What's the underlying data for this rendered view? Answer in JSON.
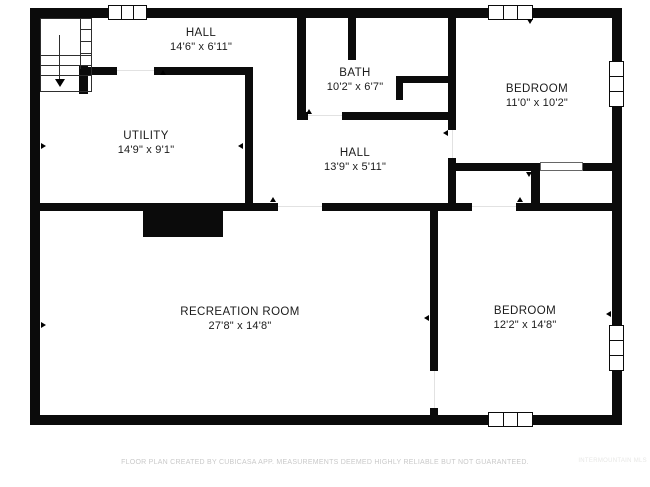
{
  "plan_type": "floor-plan",
  "colors": {
    "wall": "#0b0b0b",
    "background": "#ffffff",
    "room_label_text": "#1b1b1b",
    "footer_text": "#c9c9c9",
    "watermark_text": "#e7e7e5",
    "stairs_line": "#2e2e2e"
  },
  "rooms": [
    {
      "name": "HALL",
      "dims": "14'6\" x 6'11\""
    },
    {
      "name": "BATH",
      "dims": "10'2\" x 6'7\""
    },
    {
      "name": "BEDROOM",
      "dims": "11'0\" x 10'2\""
    },
    {
      "name": "UTILITY",
      "dims": "14'9\" x 9'1\""
    },
    {
      "name": "HALL",
      "dims": "13'9\" x 5'11\""
    },
    {
      "name": "RECREATION ROOM",
      "dims": "27'8\" x 14'8\""
    },
    {
      "name": "BEDROOM",
      "dims": "12'2\" x 14'8\""
    }
  ],
  "footer": "FLOOR PLAN CREATED BY CUBICASA APP. MEASUREMENTS DEEMED HIGHLY RELIABLE BUT NOT GUARANTEED.",
  "watermark": "INTERMOUNTAIN MLS",
  "symbols": {
    "windows": 5,
    "staircase": "down",
    "chimney": 1
  }
}
